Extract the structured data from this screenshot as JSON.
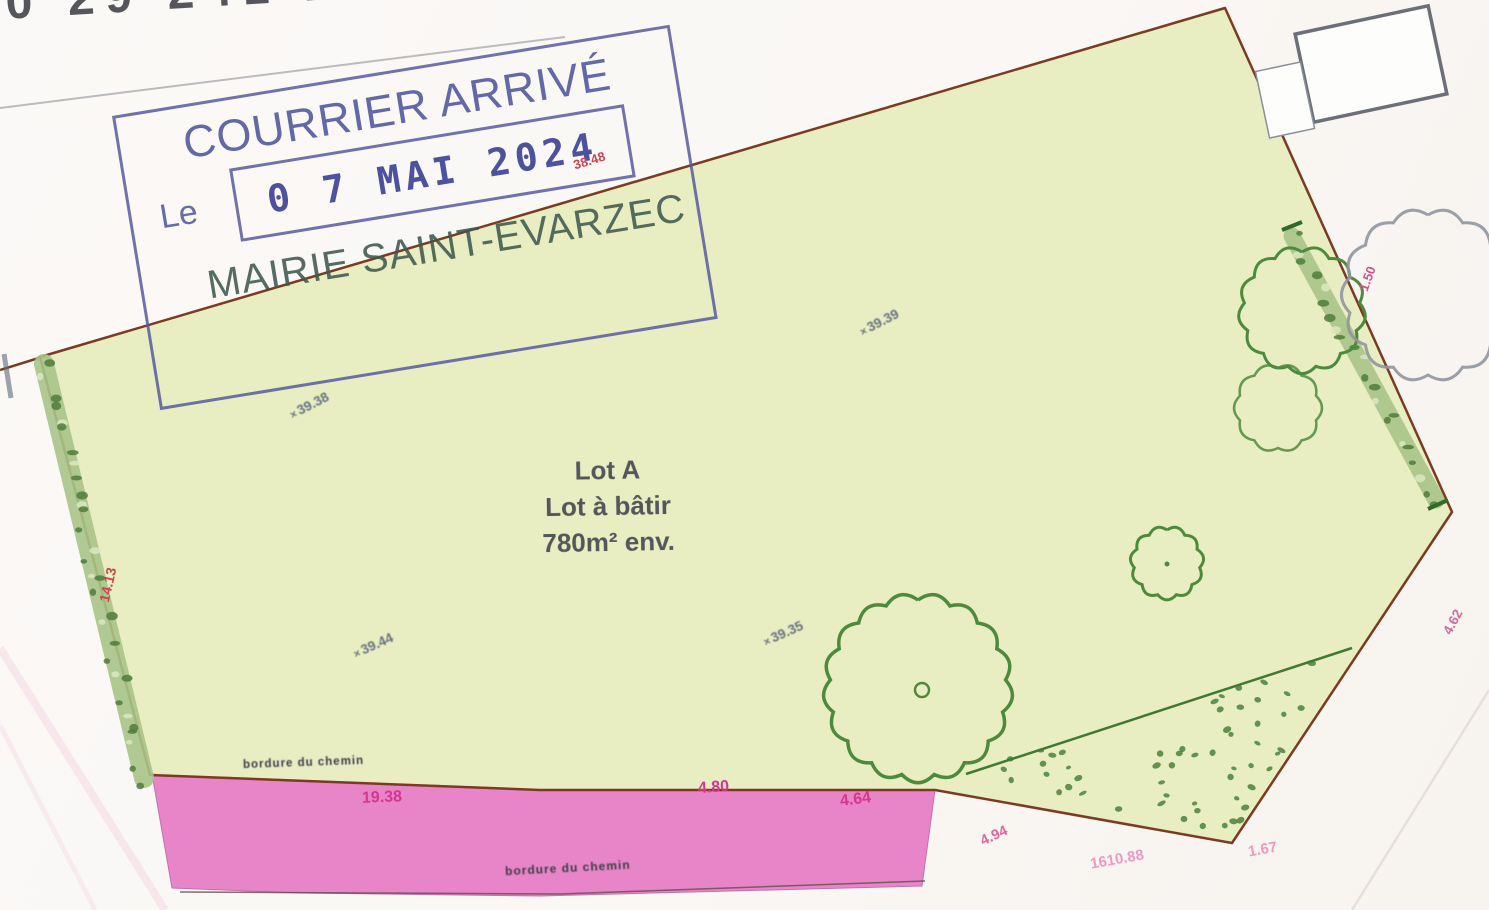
{
  "reference_number": "0 29 241 2",
  "stamp": {
    "title": "COURRIER ARRIVÉ",
    "le_label": "Le",
    "date": "0 7 MAI 2024",
    "office": "MAIRIE SAINT-EVARZEC",
    "ink_color": "#575c9f"
  },
  "parcel": {
    "lot_title": "Lot A",
    "lot_subtitle": "Lot à bâtir",
    "lot_area": "780m² env.",
    "fill_color": "#e9edc2",
    "border_color": "#7a3b22"
  },
  "road": {
    "fill_color": "#e87fc6",
    "label_top": "bordure du chemin",
    "label_bottom": "bordure du chemin",
    "measurements": [
      "19.38",
      "4.80",
      "4.64"
    ]
  },
  "measurements": {
    "top_edge": "38.48",
    "left_edge": "14.13",
    "right_edge_upper": "1.50",
    "right_edge_lower": "4.62",
    "bottom_1": "4.94",
    "bottom_2": "1610.88",
    "bottom_3": "1.67"
  },
  "spot_elevations": [
    {
      "value": "39.38"
    },
    {
      "value": "39.39"
    },
    {
      "value": "39.44"
    },
    {
      "value": "39.35"
    }
  ],
  "symbols": {
    "spot_marker": "×"
  },
  "colors": {
    "measurement_red": "#c94551",
    "road_measurement": "#d8368e",
    "tree_green": "#4e8a3e",
    "hedge_green": "#a9c489",
    "spot_gray": "#68727f"
  }
}
